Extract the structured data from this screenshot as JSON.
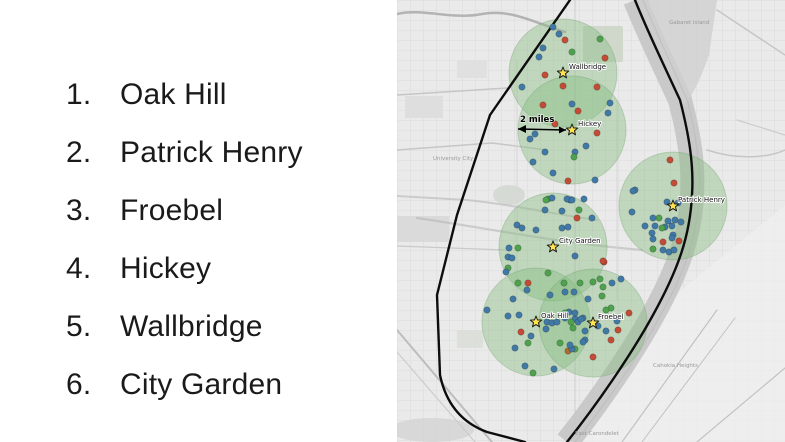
{
  "school_list": {
    "items": [
      {
        "number": "1.",
        "label": "Oak Hill"
      },
      {
        "number": "2.",
        "label": "Patrick Henry"
      },
      {
        "number": "3.",
        "label": "Froebel"
      },
      {
        "number": "4.",
        "label": "Hickey"
      },
      {
        "number": "5.",
        "label": "Wallbridge"
      },
      {
        "number": "6.",
        "label": "City Garden"
      }
    ]
  },
  "map": {
    "description": "St. Louis city map with 2-mile radius circles around six schools and colored point markers",
    "scale": {
      "label": "2 miles",
      "x1": 121,
      "y1": 129,
      "x2": 169,
      "y2": 130,
      "tx": 123,
      "ty": 122
    },
    "circle_radius_px": 54,
    "colors": {
      "dot_blue": "#4079a5",
      "dot_red": "#c44b35",
      "dot_green": "#4ea24e",
      "dot_orange": "#b06a2a",
      "circle_fill": "#86bd80",
      "circle_edge": "#6fa06a",
      "boundary": "#0d0d0d",
      "star_fill": "#ffe34f",
      "star_edge": "#1a1a1a"
    },
    "schools": [
      {
        "name": "Wallbridge",
        "x": 166,
        "y": 73,
        "lx": 172,
        "ly": 69
      },
      {
        "name": "Hickey",
        "x": 175,
        "y": 130,
        "lx": 181,
        "ly": 126
      },
      {
        "name": "Patrick Henry",
        "x": 276,
        "y": 206,
        "lx": 281,
        "ly": 202
      },
      {
        "name": "City Garden",
        "x": 156,
        "y": 247,
        "lx": 162,
        "ly": 243
      },
      {
        "name": "Oak Hill",
        "x": 139,
        "y": 322,
        "lx": 144,
        "ly": 318
      },
      {
        "name": "Froebel",
        "x": 196,
        "y": 323,
        "lx": 201,
        "ly": 319
      }
    ],
    "dots": [
      [
        156,
        27,
        "b"
      ],
      [
        162,
        34,
        "b"
      ],
      [
        168,
        40,
        "r"
      ],
      [
        203,
        39,
        "g"
      ],
      [
        146,
        48,
        "b"
      ],
      [
        175,
        52,
        "g"
      ],
      [
        142,
        57,
        "b"
      ],
      [
        208,
        58,
        "r"
      ],
      [
        148,
        75,
        "r"
      ],
      [
        125,
        87,
        "b"
      ],
      [
        166,
        86,
        "r"
      ],
      [
        200,
        87,
        "r"
      ],
      [
        146,
        105,
        "r"
      ],
      [
        175,
        104,
        "b"
      ],
      [
        213,
        103,
        "b"
      ],
      [
        181,
        111,
        "r"
      ],
      [
        211,
        113,
        "b"
      ],
      [
        158,
        124,
        "r"
      ],
      [
        138,
        134,
        "b"
      ],
      [
        133,
        139,
        "b"
      ],
      [
        200,
        133,
        "r"
      ],
      [
        189,
        146,
        "b"
      ],
      [
        178,
        152,
        "b"
      ],
      [
        148,
        152,
        "b"
      ],
      [
        177,
        157,
        "g"
      ],
      [
        136,
        162,
        "b"
      ],
      [
        156,
        173,
        "b"
      ],
      [
        171,
        181,
        "r"
      ],
      [
        198,
        180,
        "b"
      ],
      [
        238,
        190,
        "b"
      ],
      [
        151,
        199,
        "g"
      ],
      [
        173,
        200,
        "b"
      ],
      [
        187,
        199,
        "b"
      ],
      [
        273,
        160,
        "r"
      ],
      [
        277,
        183,
        "r"
      ],
      [
        236,
        191,
        "b"
      ],
      [
        270,
        202,
        "b"
      ],
      [
        281,
        203,
        "b"
      ],
      [
        235,
        212,
        "b"
      ],
      [
        262,
        218,
        "g"
      ],
      [
        256,
        218,
        "b"
      ],
      [
        271,
        221,
        "b"
      ],
      [
        278,
        220,
        "b"
      ],
      [
        284,
        222,
        "b"
      ],
      [
        258,
        226,
        "b"
      ],
      [
        268,
        227,
        "b"
      ],
      [
        275,
        226,
        "b"
      ],
      [
        248,
        226,
        "b"
      ],
      [
        265,
        228,
        "g"
      ],
      [
        255,
        233,
        "b"
      ],
      [
        276,
        235,
        "b"
      ],
      [
        266,
        242,
        "r"
      ],
      [
        282,
        241,
        "r"
      ],
      [
        275,
        238,
        "b"
      ],
      [
        256,
        239,
        "b"
      ],
      [
        256,
        249,
        "g"
      ],
      [
        266,
        250,
        "b"
      ],
      [
        272,
        252,
        "b"
      ],
      [
        277,
        250,
        "b"
      ],
      [
        149,
        200,
        "g"
      ],
      [
        155,
        198,
        "b"
      ],
      [
        170,
        199,
        "b"
      ],
      [
        175,
        200,
        "b"
      ],
      [
        182,
        210,
        "g"
      ],
      [
        148,
        210,
        "b"
      ],
      [
        165,
        211,
        "b"
      ],
      [
        180,
        218,
        "r"
      ],
      [
        195,
        218,
        "b"
      ],
      [
        120,
        225,
        "b"
      ],
      [
        125,
        228,
        "b"
      ],
      [
        139,
        230,
        "b"
      ],
      [
        165,
        228,
        "b"
      ],
      [
        171,
        227,
        "b"
      ],
      [
        112,
        248,
        "b"
      ],
      [
        121,
        248,
        "g"
      ],
      [
        111,
        257,
        "b"
      ],
      [
        115,
        258,
        "b"
      ],
      [
        178,
        256,
        "b"
      ],
      [
        111,
        268,
        "g"
      ],
      [
        207,
        262,
        "r"
      ],
      [
        109,
        272,
        "b"
      ],
      [
        151,
        273,
        "g"
      ],
      [
        131,
        283,
        "r"
      ],
      [
        167,
        283,
        "g"
      ],
      [
        196,
        282,
        "g"
      ],
      [
        206,
        287,
        "g"
      ],
      [
        177,
        292,
        "b"
      ],
      [
        168,
        292,
        "b"
      ],
      [
        121,
        283,
        "g"
      ],
      [
        130,
        290,
        "b"
      ],
      [
        116,
        299,
        "b"
      ],
      [
        153,
        295,
        "b"
      ],
      [
        90,
        310,
        "b"
      ],
      [
        111,
        316,
        "b"
      ],
      [
        122,
        315,
        "b"
      ],
      [
        150,
        322,
        "b"
      ],
      [
        155,
        323,
        "b"
      ],
      [
        160,
        322,
        "b"
      ],
      [
        168,
        318,
        "b"
      ],
      [
        172,
        312,
        "b"
      ],
      [
        178,
        319,
        "b"
      ],
      [
        174,
        322,
        "g"
      ],
      [
        181,
        322,
        "b"
      ],
      [
        186,
        318,
        "b"
      ],
      [
        124,
        332,
        "r"
      ],
      [
        149,
        329,
        "b"
      ],
      [
        176,
        328,
        "g"
      ],
      [
        134,
        336,
        "b"
      ],
      [
        163,
        343,
        "g"
      ],
      [
        118,
        348,
        "b"
      ],
      [
        131,
        343,
        "g"
      ],
      [
        171,
        351,
        "o"
      ],
      [
        178,
        349,
        "g"
      ],
      [
        128,
        366,
        "b"
      ],
      [
        157,
        369,
        "b"
      ],
      [
        136,
        373,
        "g"
      ],
      [
        206,
        261,
        "r"
      ],
      [
        203,
        279,
        "g"
      ],
      [
        224,
        279,
        "b"
      ],
      [
        215,
        283,
        "b"
      ],
      [
        183,
        283,
        "g"
      ],
      [
        205,
        296,
        "g"
      ],
      [
        191,
        299,
        "b"
      ],
      [
        214,
        308,
        "g"
      ],
      [
        209,
        310,
        "g"
      ],
      [
        178,
        313,
        "b"
      ],
      [
        168,
        313,
        "g"
      ],
      [
        184,
        319,
        "b"
      ],
      [
        232,
        313,
        "r"
      ],
      [
        220,
        321,
        "b"
      ],
      [
        201,
        326,
        "b"
      ],
      [
        221,
        330,
        "r"
      ],
      [
        209,
        331,
        "b"
      ],
      [
        188,
        331,
        "b"
      ],
      [
        188,
        340,
        "b"
      ],
      [
        214,
        340,
        "r"
      ],
      [
        186,
        342,
        "b"
      ],
      [
        175,
        349,
        "b"
      ],
      [
        196,
        357,
        "r"
      ],
      [
        173,
        345,
        "b"
      ]
    ],
    "base_labels": [
      {
        "text": "University City",
        "x": 36,
        "y": 160
      },
      {
        "text": "Gabaret Island",
        "x": 272,
        "y": 24
      },
      {
        "text": "Cahokia Heights",
        "x": 256,
        "y": 367
      },
      {
        "text": "East Carondelet",
        "x": 178,
        "y": 435
      }
    ]
  }
}
